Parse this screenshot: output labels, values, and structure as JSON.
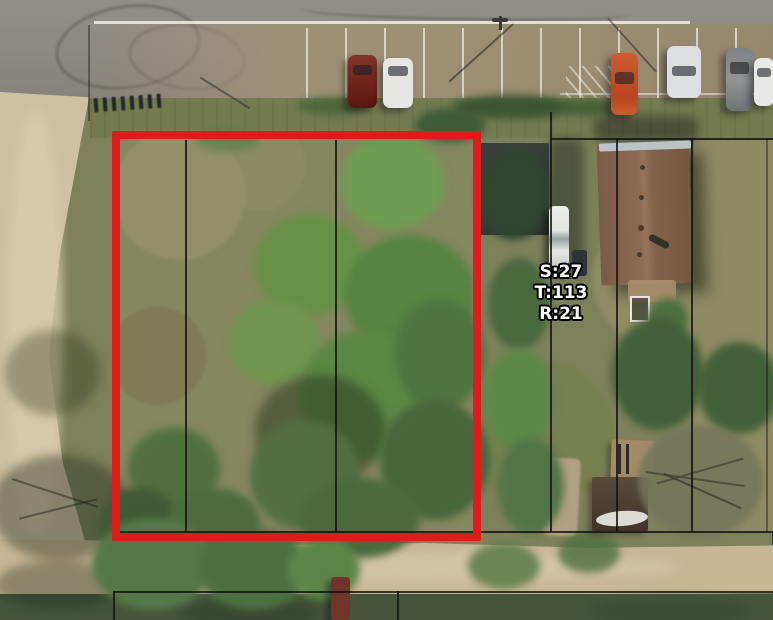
{
  "map": {
    "view": "aerial-parcel-map",
    "label": {
      "section": "S:27",
      "township": "T:113",
      "range": "R:21"
    },
    "colors": {
      "selected_parcel_outline": "#e11a1c",
      "parcel_boundary_line": "#141414",
      "label_text": "#ffffff",
      "label_halo": "#000000",
      "asphalt_road": "#8e8b85",
      "parking_lot": "#a29176",
      "gravel_road": "#cec0a2",
      "grass": "#7d815a",
      "tree_canopy": "#5d8746",
      "house_roof": "#8a6850",
      "dark_roof": "#343936"
    },
    "features": {
      "selected_parcel": "red-outlined vacant lot",
      "boundaries": "black parcel lines",
      "north_road": "paved road with parking stalls",
      "west_road": "gravel road",
      "south_road": "gravel road",
      "house": "brown-roof house",
      "outbuilding": "dark-roof building",
      "sheds": "two sheds with boat",
      "vehicles": "parked cars and trucks"
    }
  }
}
